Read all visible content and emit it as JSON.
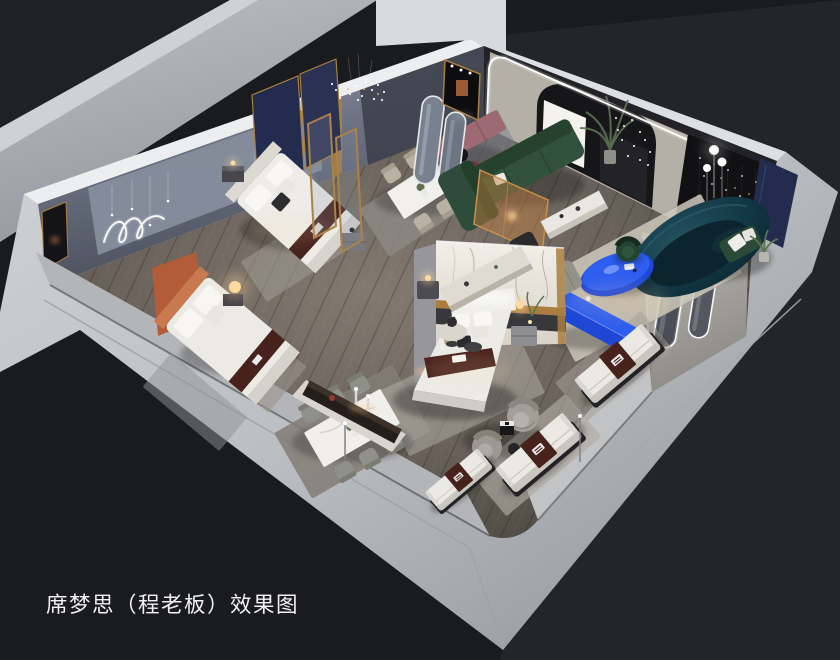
{
  "image": {
    "width": 840,
    "height": 660,
    "kind": "3D isometric cutaway interior render of a mattress showroom"
  },
  "caption": {
    "text": "席梦思（程老板）效果图"
  },
  "palette": {
    "background": "#1a1b1e",
    "background_right": "#242529",
    "caption_color": "#f2f2f2",
    "wall_light": "#c3c6ca",
    "wall_top_strip": "#eceef0",
    "wall_interior": "#6d7380",
    "floor_wood": "#6f6761",
    "accent_blue": "#2e5ef0",
    "accent_blue_deep": "#1e47d6",
    "sofa_teal": "#10303c",
    "sofa_green": "#31513d",
    "marble": "#efece6",
    "gold": "#a97e3e",
    "navy_panel": "#232b4f",
    "runner_brown": "#47211c",
    "rust_orange": "#b25d38",
    "mauve": "#9d6a73",
    "lamp_warm": "#ffd9a0",
    "led_white": "#ffffff"
  },
  "scene": {
    "rooms": [
      "bedroom display (back left)",
      "dining display",
      "lounge living display (back right)",
      "bedroom display (center)",
      "mattress display zone (front right)"
    ],
    "objects": [
      "double bed with navy headboard panels",
      "double bed with rust headboard",
      "double bed with marble feature partition",
      "three branded display mattresses",
      "two dining table sets with chairs",
      "green L-shaped sectional sofa",
      "dark teal curved sofa",
      "blue organic coffee table",
      "blue media console",
      "arched LED portal wall with palm plant and string lights",
      "dark feature wall with fairy lights",
      "navy wall panels",
      "arched mirror niches with LED trim",
      "pill-shaped floor mirrors",
      "wavy neon wall light",
      "fairy-light chandelier",
      "globe floor lamp",
      "glowing orb table lamps",
      "gray swivel barrel chairs with side tables",
      "mauve bench with burgundy chairs",
      "amber glass partition",
      "cream console bench",
      "marble display alcove with cabinet and lamps",
      "area rugs"
    ]
  }
}
